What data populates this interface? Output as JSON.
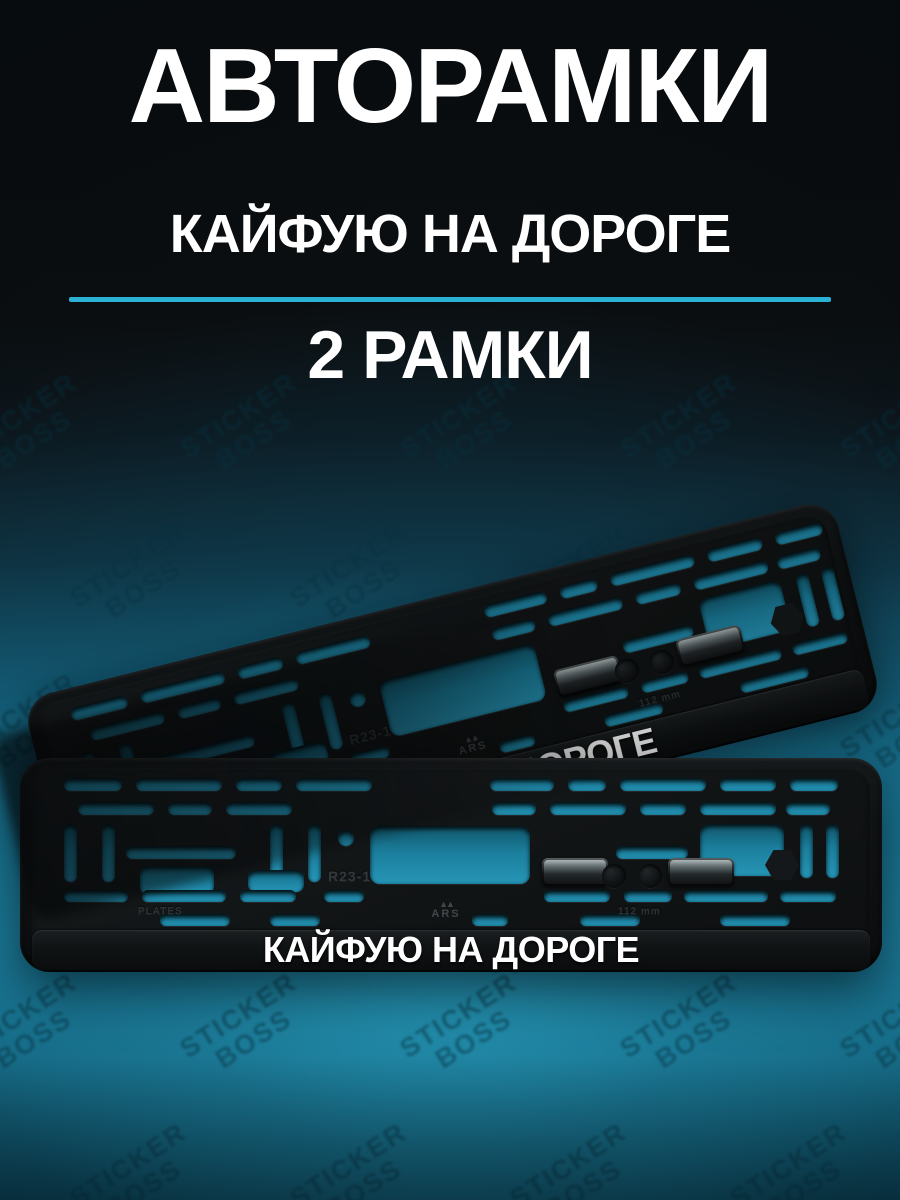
{
  "header": {
    "title": "АВТОРАМКИ",
    "subtitle": "КАЙФУЮ НА ДОРОГЕ",
    "count_label": "2 РАМКИ"
  },
  "product": {
    "frame_text": "КАЙФУЮ НА ДОРОГЕ",
    "mold_code": "R23-1",
    "mold_plates": "PLATES",
    "mold_size": "112 mm",
    "brand_mark": "ARS"
  },
  "watermark": {
    "line1": "STICKER",
    "line2": "BOSS"
  },
  "colors": {
    "divider_accent": "#2cb1d6",
    "background_glow": "#1e8aab",
    "frame_black": "#101314",
    "text_white": "#ffffff"
  }
}
